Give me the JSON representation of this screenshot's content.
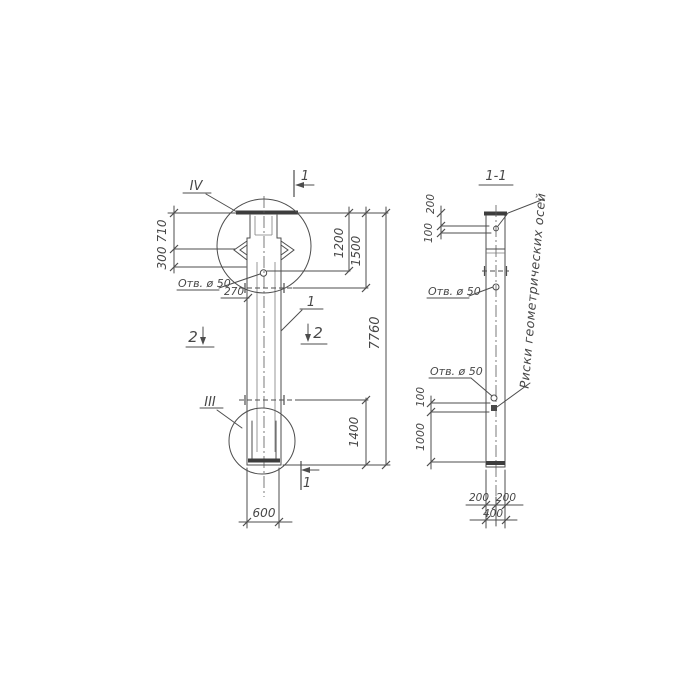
{
  "colors": {
    "ink": "#4a4a4a",
    "paper": "#ffffff"
  },
  "front_view": {
    "detail_top_label": "IV",
    "detail_bottom_label": "III",
    "section1_top_label": "1",
    "section1_bottom_label": "1",
    "section2_left_label": "2",
    "section2_right_label": "2",
    "position_label": "1",
    "hole_label": "Отв. ø 50",
    "dim_710": "710",
    "dim_300": "300",
    "dim_270": "270",
    "dim_1200": "1200",
    "dim_1500": "1500",
    "dim_7760": "7760",
    "dim_1400": "1400",
    "dim_600": "600"
  },
  "section_view": {
    "title": "1-1",
    "hole_label_upper": "Отв. ø 50",
    "hole_label_lower": "Отв. ø 50",
    "axes_note": "Риски геометрических осей",
    "dim_200_top": "200",
    "dim_100_top": "100",
    "dim_100_mid": "100",
    "dim_1000": "1000",
    "dim_200_bottom_left": "200",
    "dim_200_bottom_right": "200",
    "dim_400": "400"
  }
}
